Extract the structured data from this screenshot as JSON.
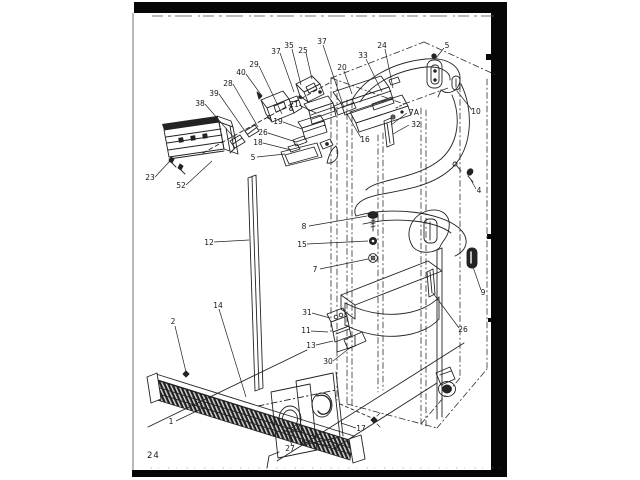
{
  "page": {
    "number": "24"
  },
  "colors": {
    "ink": "#232323",
    "paper": "#ffffff",
    "scan_black": "#060606"
  },
  "callouts": [
    "38",
    "39",
    "28",
    "40",
    "29",
    "37",
    "35",
    "25",
    "37",
    "23",
    "52",
    "21",
    "19",
    "26",
    "18",
    "5",
    "16",
    "20",
    "33",
    "24",
    "5",
    "10",
    "7A",
    "32",
    "4",
    "8",
    "15",
    "7",
    "12",
    "9",
    "26",
    "31",
    "11",
    "13",
    "30",
    "14",
    "2",
    "1",
    "27",
    "3",
    "17"
  ]
}
